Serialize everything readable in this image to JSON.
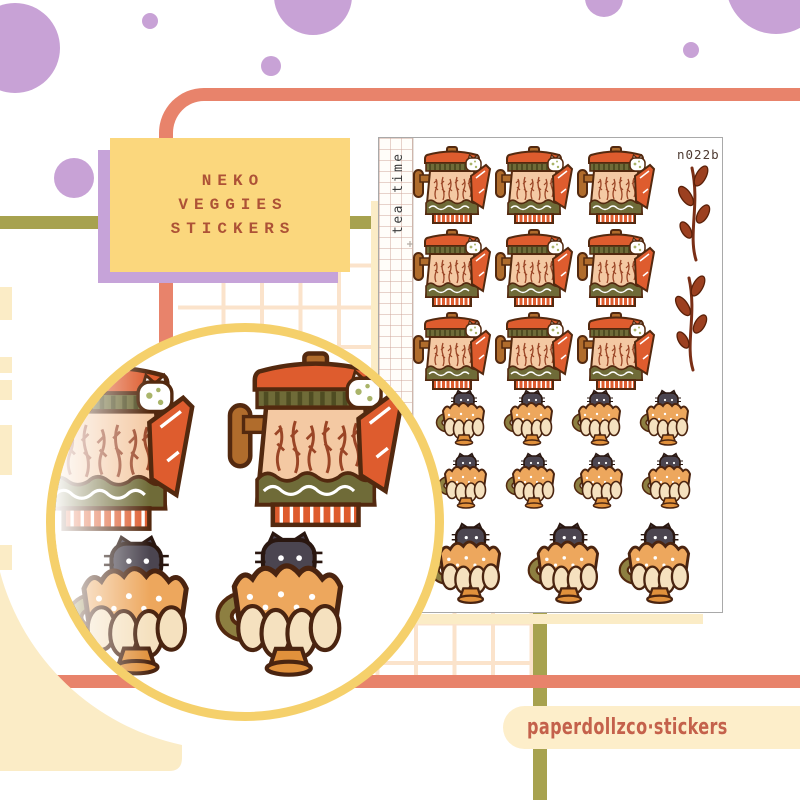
{
  "title_card": {
    "lines": [
      "NEKO",
      "VEGGIES",
      "STICKERS"
    ]
  },
  "sticker_sheet": {
    "code": "n022b",
    "side_label": "tea time",
    "teapot_count": 9,
    "small_teacup_count": 8,
    "large_teacup_count": 3,
    "leaf_sprig_count": 2
  },
  "footer": {
    "handle": "paperdollzco·stickers",
    "icons": [
      "tiktok-icon",
      "instagram-icon"
    ]
  },
  "colors": {
    "coral_frame": "#e8836b",
    "olive_line": "#a7a24f",
    "lilac_dot": "#c8a2d6",
    "card_yellow": "#fbd77d",
    "card_shadow_purple": "#c6a3d9",
    "card_text_brown": "#ad5236",
    "cream": "#fbecc6",
    "circle_ring_yellow": "#f5d06b",
    "footer_terracotta": "#c4614b",
    "teapot_orange": "#de5c2e",
    "teapot_peach": "#f4c9a3",
    "band_olive": "#6f6b38",
    "cup_orange": "#eda75d",
    "cat_charcoal": "#4b4550",
    "leaf_rust": "#9c4020"
  }
}
